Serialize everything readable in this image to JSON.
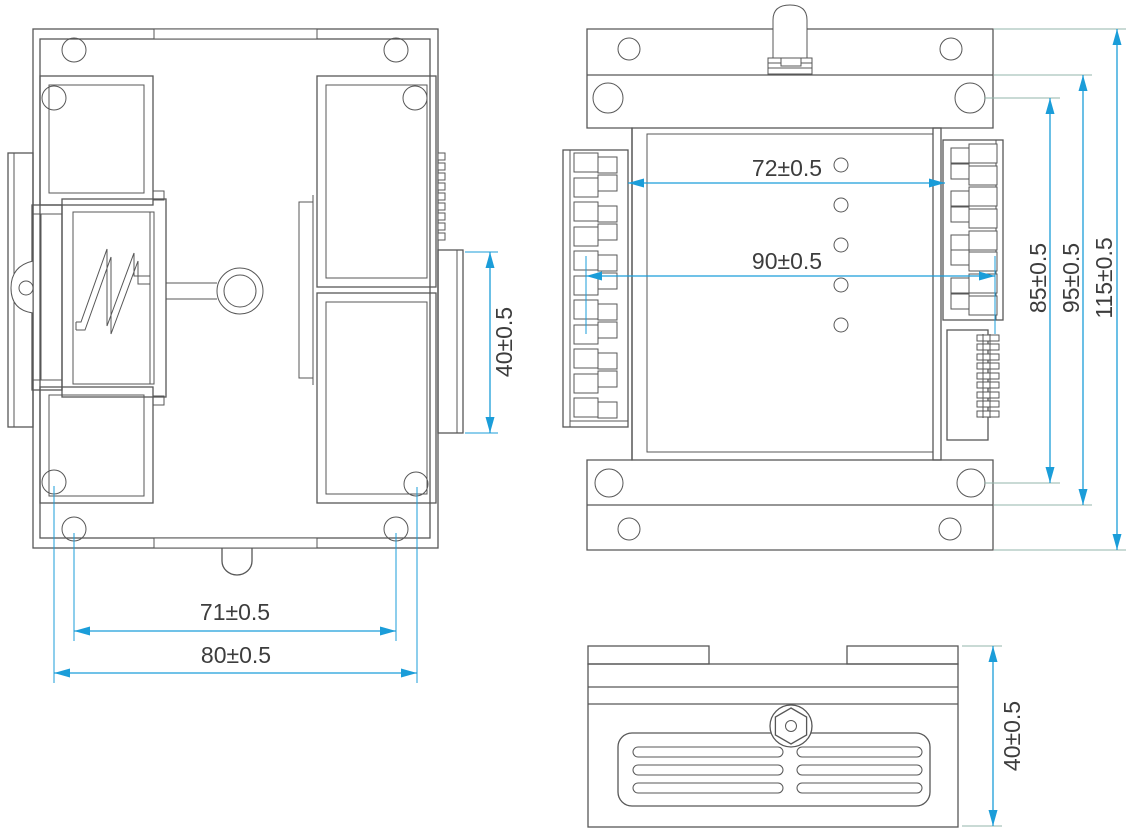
{
  "colors": {
    "background": "#ffffff",
    "line": "#575757",
    "dimension": "#1b9dd9",
    "leader": "#93b5ab",
    "text": "#3d3d3d"
  },
  "views": {
    "bottom_view": {
      "dims": {
        "hole_span": "71±0.5",
        "body_width": "80±0.5",
        "connector_width": "40±0.5"
      }
    },
    "top_view": {
      "dims": {
        "inner_body_width": "72±0.5",
        "terminal_span": "90±0.5",
        "hole_span": "85±0.5",
        "flange_span": "95±0.5",
        "overall_height": "115±0.5"
      }
    },
    "side_view": {
      "dims": {
        "body_height": "40±0.5"
      }
    }
  }
}
